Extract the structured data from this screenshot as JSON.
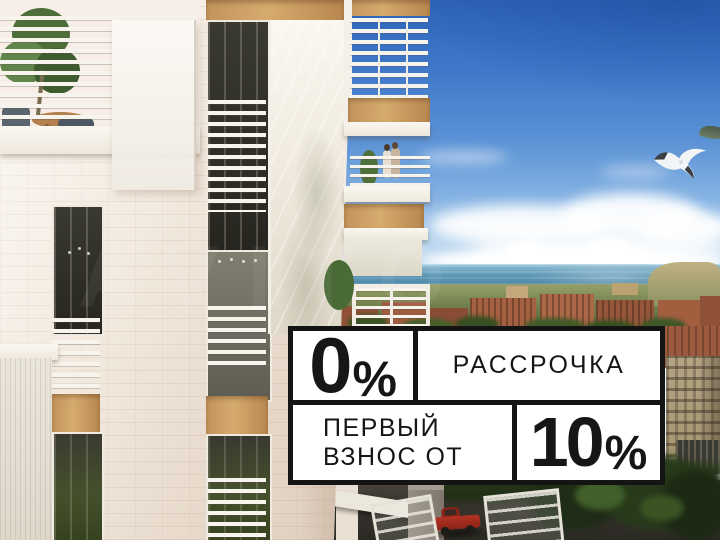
{
  "promo": {
    "installment": {
      "value": "0",
      "unit": "%",
      "label": "РАССРОЧКА"
    },
    "first_payment": {
      "label_line1": "ПЕРВЫЙ",
      "label_line2": "ВЗНОС ОТ",
      "value": "10",
      "unit": "%"
    }
  },
  "watermark": {
    "text": "AVITO"
  },
  "palette": {
    "promo_background": "#ffffff",
    "promo_border": "#141414",
    "promo_text": "#161616",
    "sky_deep_blue": "#2e62b6",
    "sea_teal": "#4a84a4",
    "facade_cream": "#f2eadf",
    "wood_accent": "#c89a62",
    "foliage_green": "#3c5526",
    "truck_red": "#a82c1f"
  }
}
